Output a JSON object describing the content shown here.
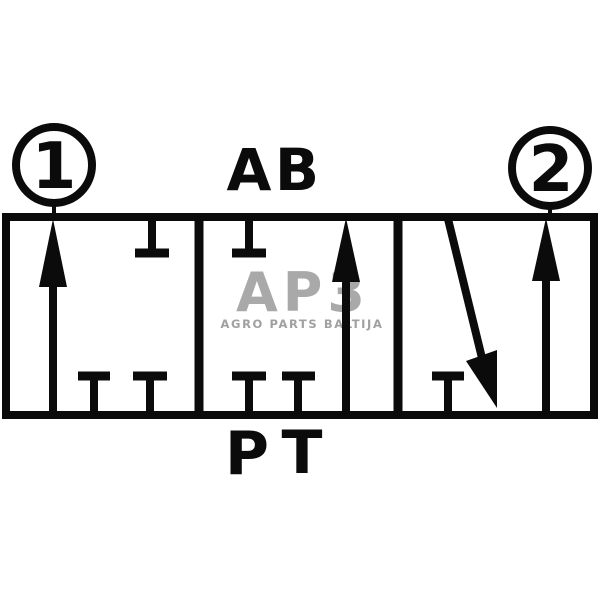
{
  "colors": {
    "line": "#0b0b0b",
    "background": "#ffffff",
    "watermark_logo": "#a9a9a9",
    "watermark_text": "#a0a0a0"
  },
  "ports": {
    "circle_left": "1",
    "circle_right": "2",
    "top_a": "A",
    "top_b": "B",
    "bottom_p": "P",
    "bottom_t": "T"
  },
  "watermark": {
    "logo": "AP3",
    "subtitle": "AGRO PARTS BALTIJA"
  }
}
